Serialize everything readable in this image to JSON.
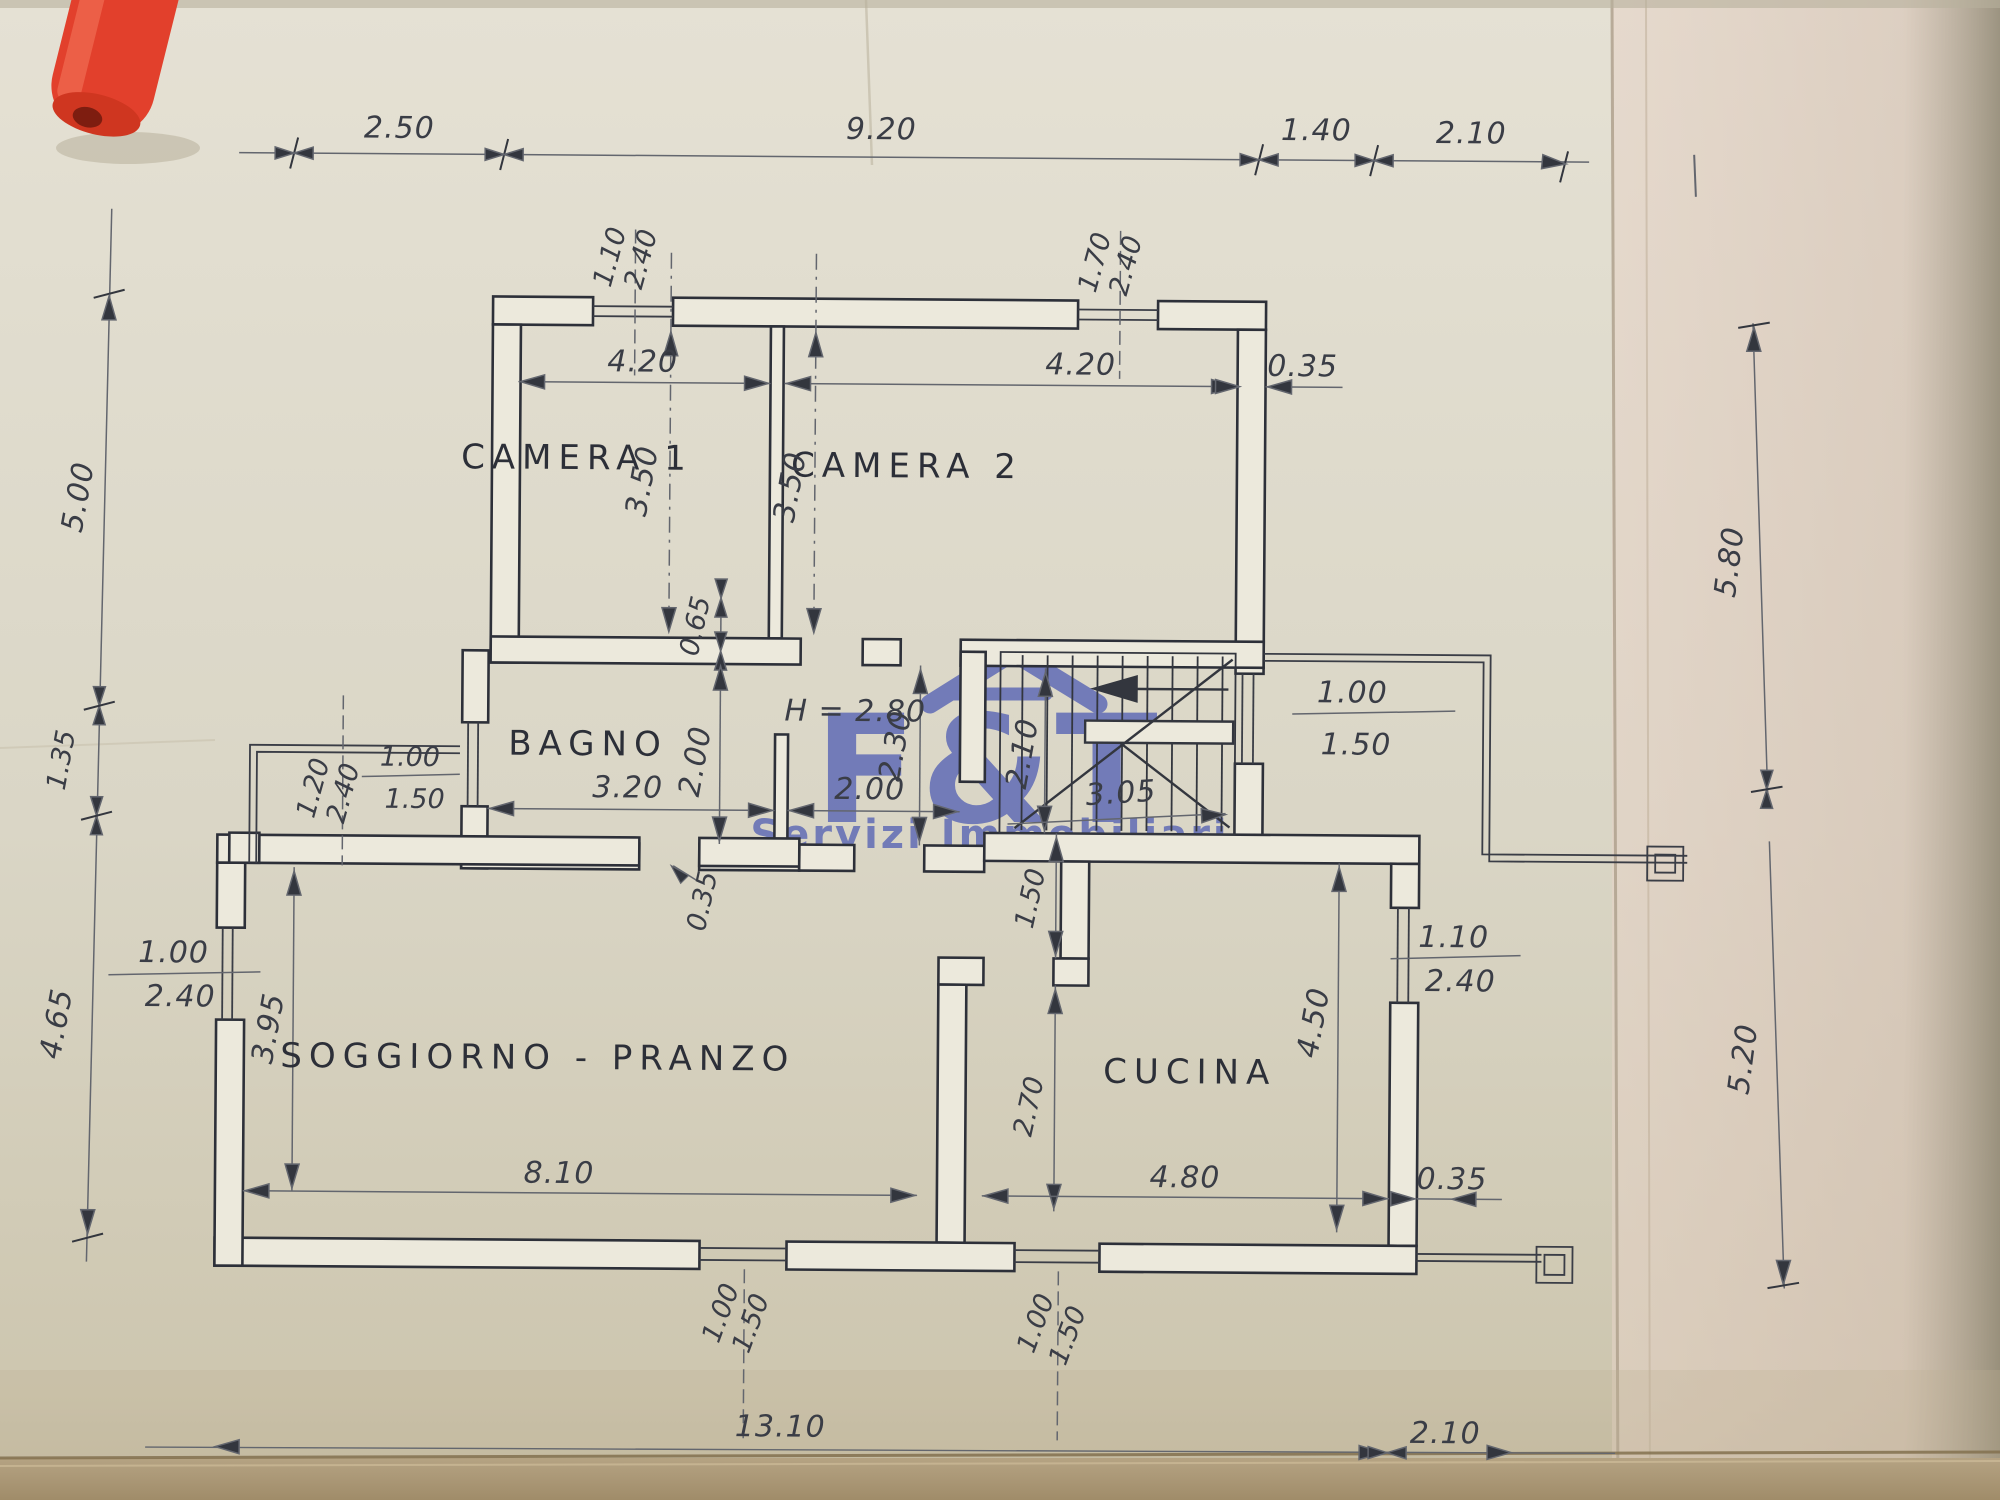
{
  "document": {
    "kind": "scanned floor plan",
    "watermark": {
      "brand": "F&T",
      "subtitle": "Servizi Immobiliari"
    },
    "rooms": {
      "camera1": "CAMERA 1",
      "camera2": "CAMERA 2",
      "bagno": "BAGNO",
      "soggiorno": "SOGGIORNO - PRANZO",
      "cucina": "CUCINA",
      "height_note": "H = 2.80"
    },
    "dims": {
      "top_1": "2.50",
      "top_2": "9.20",
      "top_3": "1.40",
      "top_4": "2.10",
      "win_cam1_w": "1.10",
      "win_cam1_h": "2.40",
      "win_cam2_w": "1.70",
      "win_cam2_h": "2.40",
      "cam1_width": "4.20",
      "cam2_width": "4.20",
      "wall_top_right": "0.35",
      "cam1_depth": "3.50",
      "cam2_depth": "3.50",
      "offset_mid": "0.65",
      "hall_depth": "2.30",
      "hall_width": "2.00",
      "bagno_width": "3.20",
      "bagno_depth": "2.00",
      "win_bagno_w": "1.00",
      "win_bagno_h": "1.50",
      "door_terrace_w": "1.20",
      "door_terrace_h": "2.40",
      "stair_depth": "2.10",
      "stair_width": "3.05",
      "win_stair_w": "1.00",
      "win_stair_h": "1.50",
      "wall_mid": "0.35",
      "left_1": "5.00",
      "left_2": "1.35",
      "left_3": "4.65",
      "right_1": "5.80",
      "right_2": "5.20",
      "win_sogg_left_w": "1.00",
      "win_sogg_left_h": "2.40",
      "sogg_depth": "3.95",
      "kitchen_top": "1.50",
      "kitchen_pass": "2.70",
      "kitchen_depth": "4.50",
      "win_cucina_w": "1.10",
      "win_cucina_h": "2.40",
      "sogg_width": "8.10",
      "cucina_width": "4.80",
      "wall_bottom_right": "0.35",
      "win_bottom1_w": "1.00",
      "win_bottom1_h": "1.50",
      "win_bottom2_w": "1.00",
      "win_bottom2_h": "1.50",
      "total_width": "13.10",
      "bottom_right": "2.10"
    }
  }
}
